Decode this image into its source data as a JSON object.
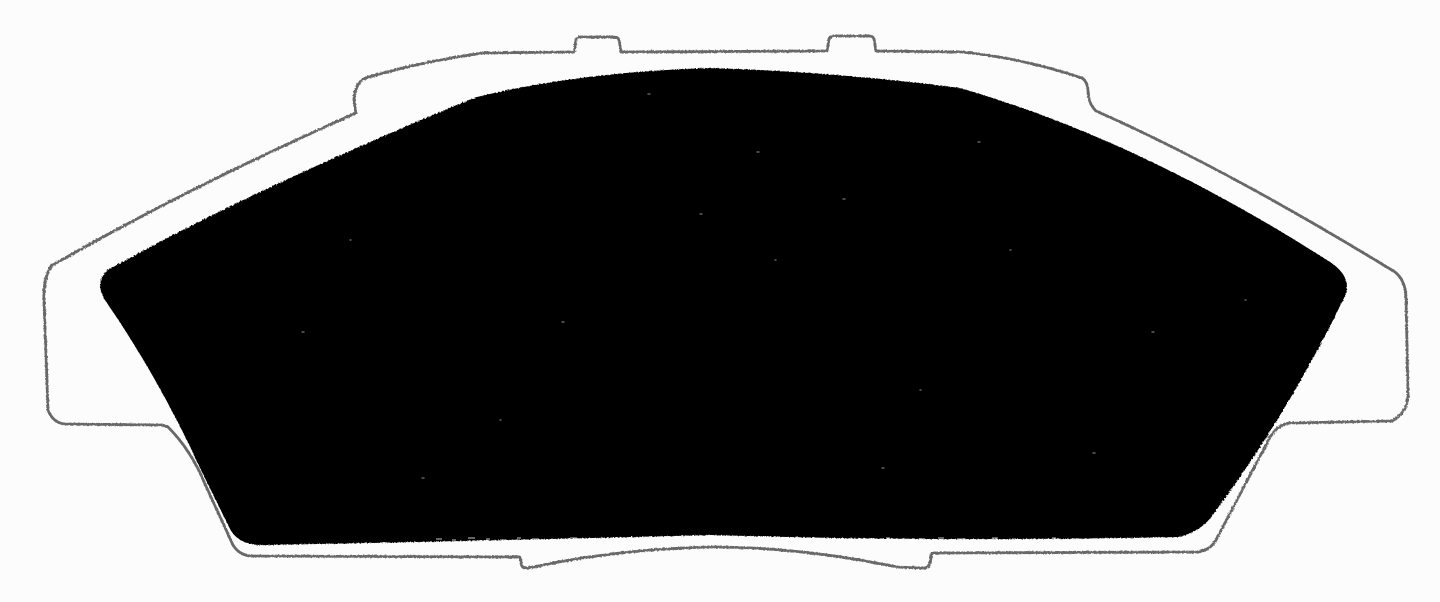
{
  "figure": {
    "subject": "Disc brake pad: black friction material silhouette mounted on a backing plate shown as a thin outline",
    "style": "Scanned monochrome catalog line art, no text or labels",
    "canvas_width": 1440,
    "canvas_height": 602,
    "features": [
      "two top abutment tabs",
      "stepped upper shoulders left and right",
      "side abutment shelves at mid height",
      "bottom edge with central hump and two small steps",
      "speckle noise along lower pad edge"
    ]
  },
  "colors": {
    "background": "#fcfcfc",
    "outline": "#676767",
    "pad": "#060606",
    "speckle": "#f2f2f2"
  },
  "shapes": {
    "backing_plate_outline": "M356 113 Q352 95 357 87 Q360 79 369 77 Q420 62 483 53 L574 52 L576 40 Q577 37 581 37 L614 37 Q618 37 619 40 L621 52 L827 51 L829 39 Q830 36 834 36 L869 36 Q873 36 874 39 L876 51 L962 52 Q1022 58 1082 78 Q1087 81 1088 90 Q1088 103 1096 111 Q1225 168 1395 272 Q1405 280 1406 296 L1408 396 Q1407 413 1392 421 L1289 423 Q1276 425 1268 441 L1217 538 Q1212 549 1199 552 L932 553 L930 563 Q929 568 923 568 L897 567 Q800 547 711 547 Q616 549 528 568 Q521 569 521 562 L520 557 L251 556 Q239 555 233 545 L205 484 Q191 450 168 427 Q164 425 159 425 L65 424 Q53 423 48 410 L44 300 Q43 280 51 266 Q195 184 356 113 Z",
    "friction_pad": "M477 97 Q580 72 710 68 Q840 72 960 88 Q1140 140 1330 262 Q1354 278 1344 298 Q1290 410 1215 512 Q1202 532 1178 537 Q940 542 711 535 Q478 541 268 545 Q238 547 229 527 L201 470 Q160 380 105 300 Q95 284 106 271 Q240 196 440 112 Q458 104 477 97 Z",
    "pad_edge_speckles": "M436 539h6M452 540h4M468 538h7M486 539h4M500 540h6M517 538h4M532 539h7M552 540h5M570 538h7M590 539h4M608 540h6M626 539h4M868 539h6M886 538h4M902 540h7M921 539h4M938 538h6M957 539h8M975 540h4M992 538h6M1012 539h4M1030 540h7M1052 538h4M1072 539h6M1092 539h5",
    "pad_surface_specks": "M757 152h2M843 199h2M700 214h2M1093 453h2M562 322h2M978 142h2M422 478h2M1152 332h2M302 332h2M882 468h2M648 94h2M775 260h1M920 390h1M1245 300h1M350 240h1M500 420h1M1010 250h1"
  }
}
